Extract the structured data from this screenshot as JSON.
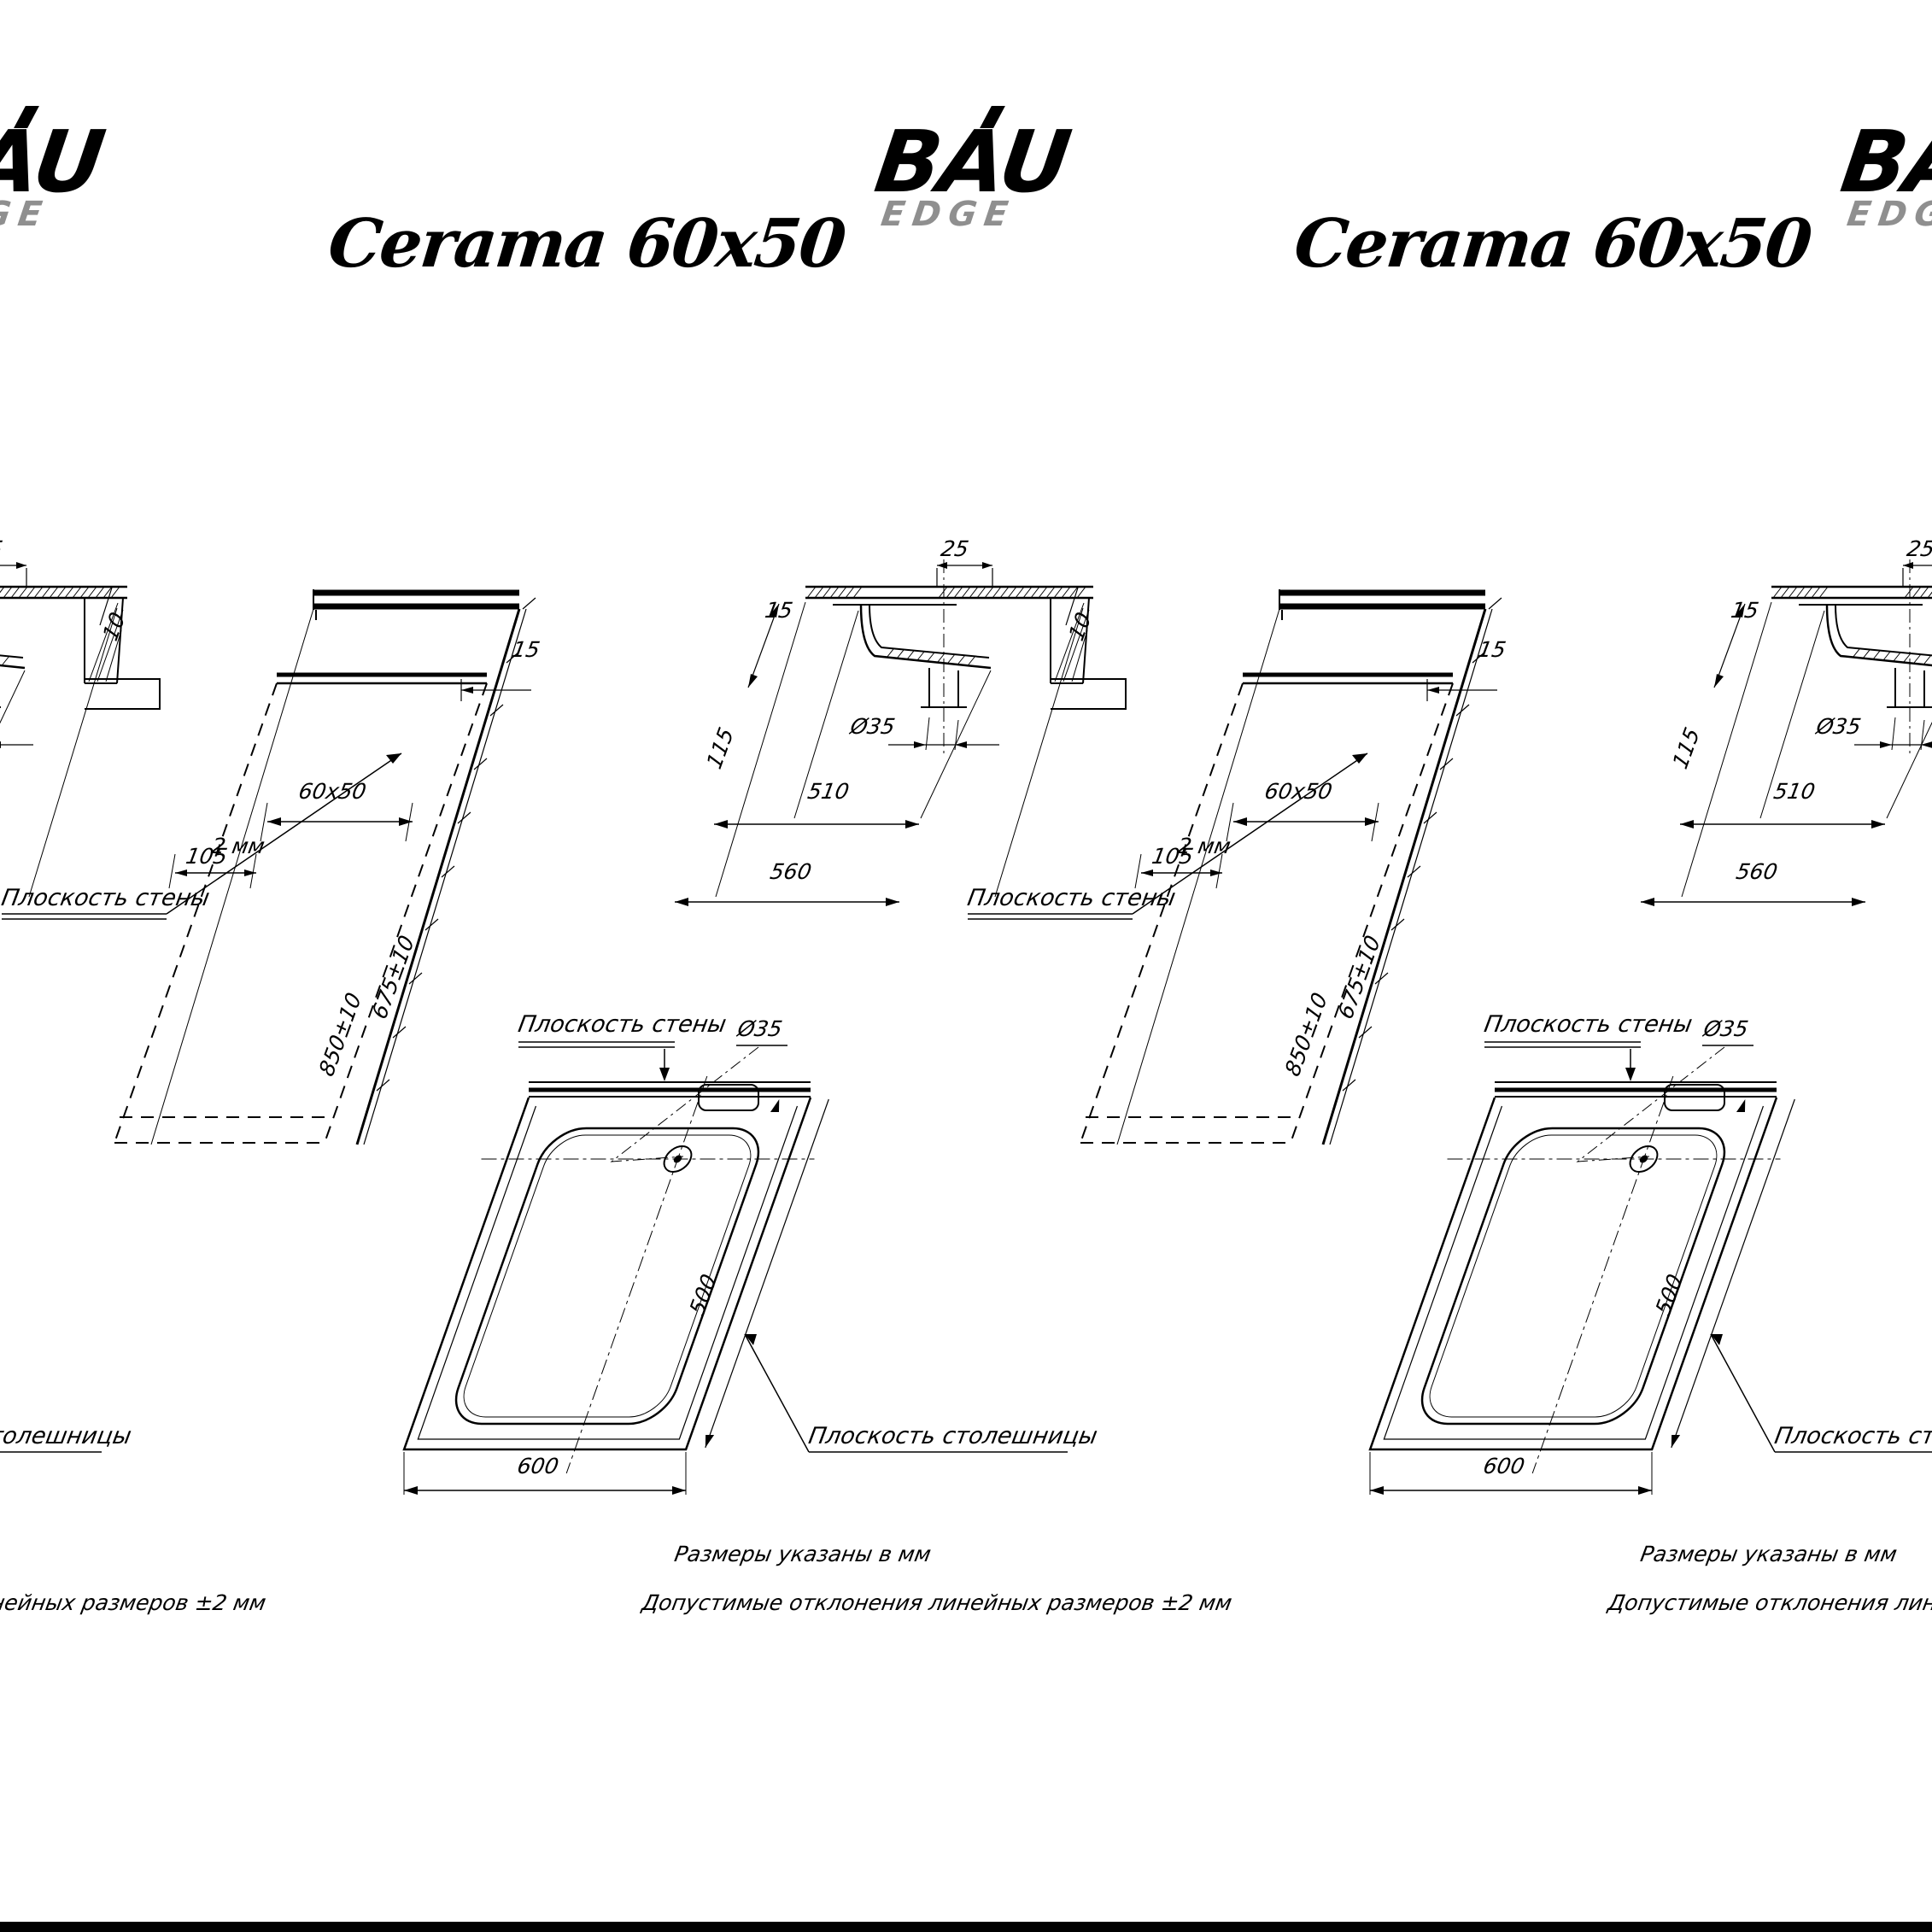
{
  "brand": {
    "name": "BAU",
    "sub": "EDGE",
    "accent_color": "#8f8f8f"
  },
  "title": "Cerama 60x50",
  "labels": {
    "wall_plane": "Плоскость стены",
    "countertop_plane": "Плоскость столешницы"
  },
  "side_view": {
    "dims": {
      "width_label": "60х50",
      "gap": "2 мм",
      "ledge": "105",
      "edge": "15",
      "machine_height": "850±10",
      "machine_depth": "675±10"
    }
  },
  "section_view": {
    "dims": {
      "top": "25",
      "right": "10",
      "left_top": "15",
      "left_height": "115",
      "drain": "Ø35",
      "bowl_width": "510",
      "cutout_width": "560"
    }
  },
  "top_view": {
    "dims": {
      "drain": "Ø35",
      "width": "600",
      "depth": "500"
    }
  },
  "notes": [
    "Размеры указаны в мм",
    "Допустимые отклонения линейных размеров ±2 мм"
  ],
  "colors": {
    "line": "#000000",
    "background": "#ffffff",
    "footer_bar": "#000000"
  }
}
